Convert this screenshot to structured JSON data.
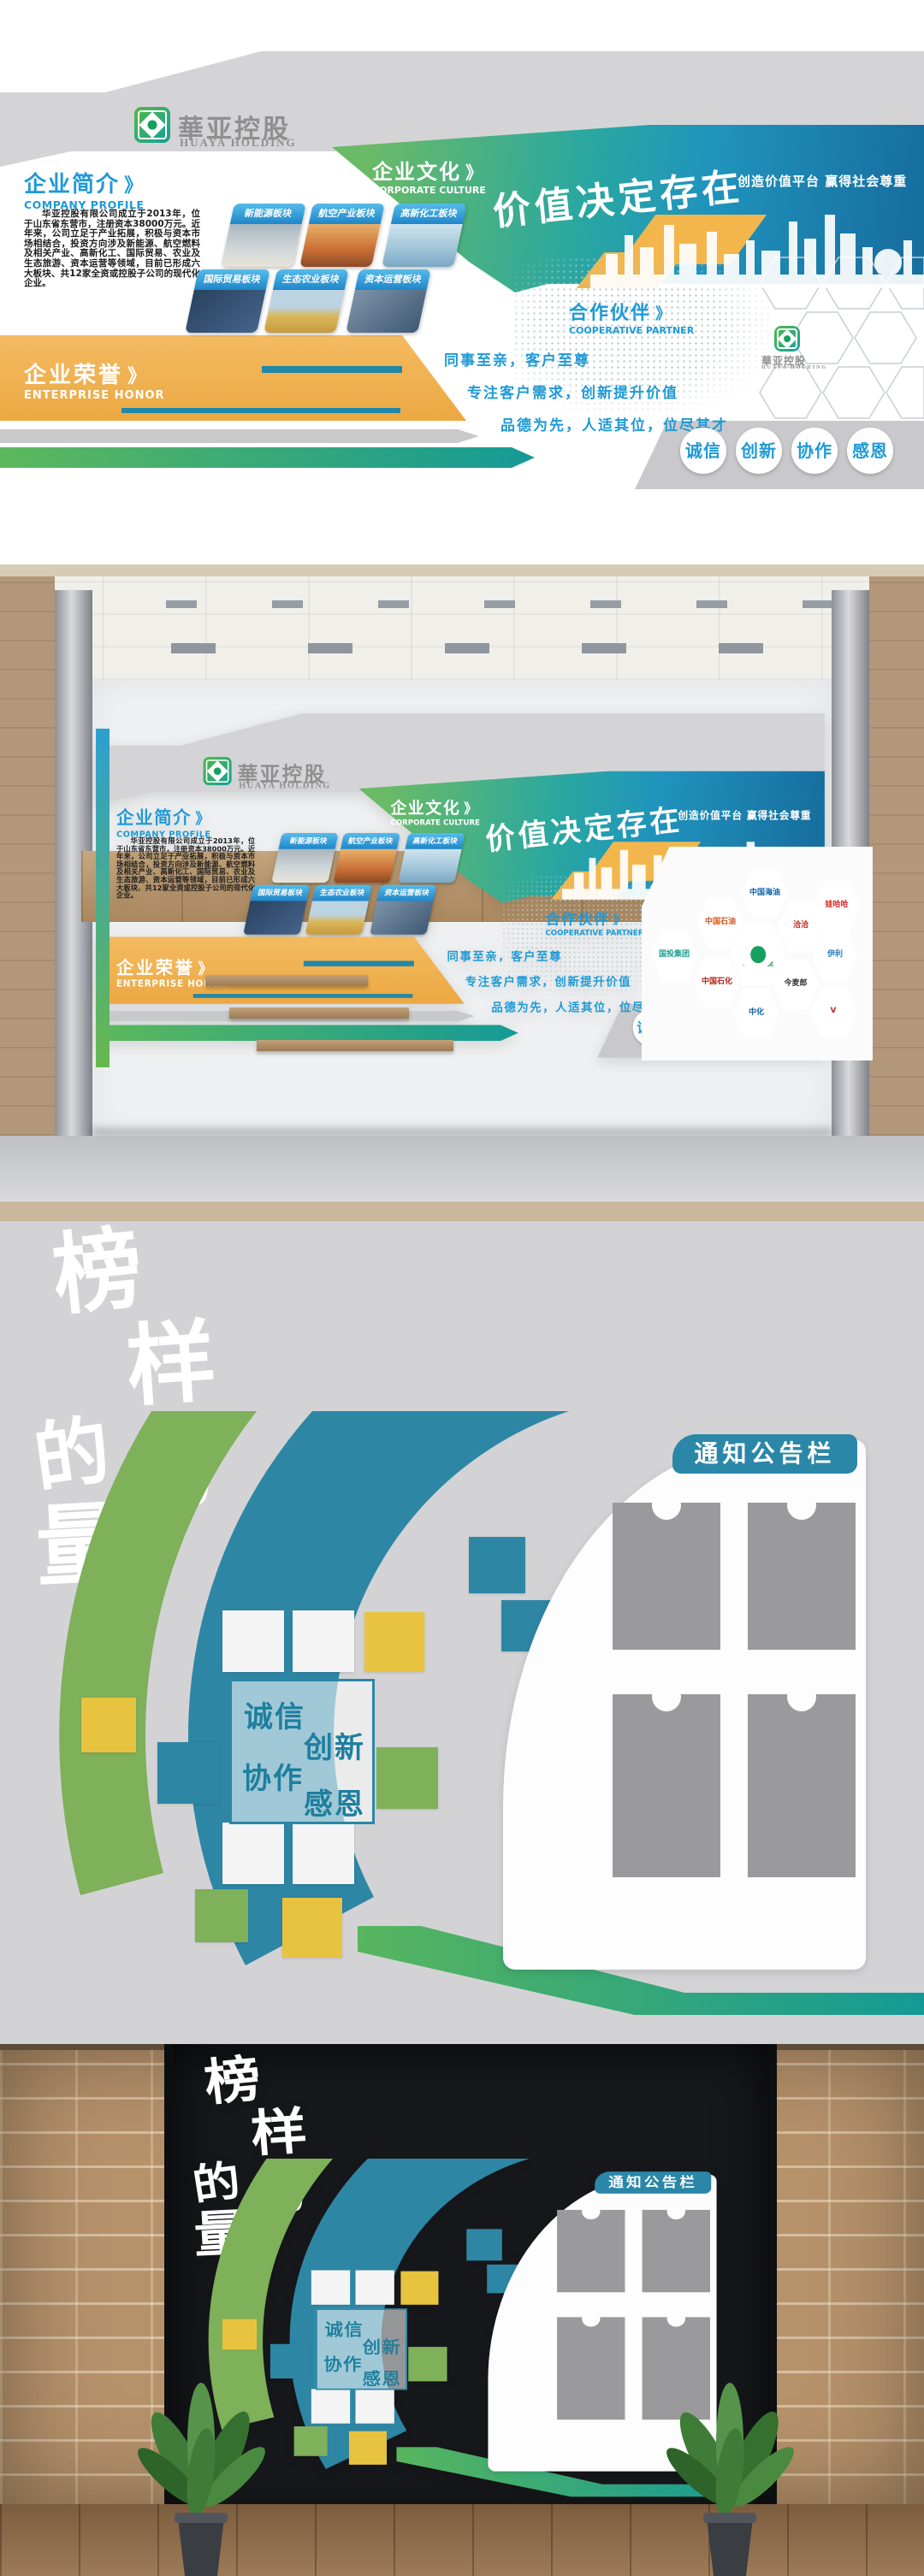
{
  "brand": {
    "logo_cn": "華亚控股",
    "logo_en": "HUAYA HOLDING"
  },
  "decor": {
    "chevron": "》"
  },
  "design1": {
    "profile": {
      "title_cn": "企业简介",
      "title_en": "COMPANY PROFILE",
      "body": "华亚控股有限公司成立于2013年，位于山东省东营市，注册资本38000万元。近年来，公司立足于产业拓展，积极与资本市场相结合，投资方向涉及新能源、航空燃料及相关产业、高新化工、国际贸易、农业及生态旅游、资本运营等领域，目前已形成六大板块、共12家全资或控股子公司的现代化企业。"
    },
    "sectors": [
      "新能源板块",
      "航空产业板块",
      "高新化工板块",
      "国际贸易板块",
      "生态农业板块",
      "资本运营板块"
    ],
    "culture": {
      "title_cn": "企业文化",
      "title_en": "CORPORATE CULTURE",
      "slogan": "价值决定存在",
      "subslogan": "创造价值平台 赢得社会尊重"
    },
    "partner": {
      "title_cn": "合作伙伴",
      "title_en": "COOPERATIVE PARTNER"
    },
    "honor": {
      "title_cn": "企业荣誉",
      "title_en": "ENTERPRISE HONOR"
    },
    "mottoes": [
      "同事至亲，客户至尊",
      "专注客户需求，创新提升价值",
      "品德为先，人适其位，位尽其才"
    ],
    "values": [
      "诚信",
      "创新",
      "协作",
      "感恩"
    ]
  },
  "render1": {
    "partners": [
      {
        "label": "中国海油",
        "color": "#1160a6"
      },
      {
        "label": "娃哈哈",
        "color": "#d02a2a"
      },
      {
        "label": "中国石油",
        "color": "#d4571e"
      },
      {
        "label": "洽洽",
        "color": "#cc2222"
      },
      {
        "label": "国投集团",
        "color": "#1a9e8f"
      },
      {
        "label": "華亚控股",
        "color": "#2f9e52"
      },
      {
        "label": "伊利",
        "color": "#2a7fc0"
      },
      {
        "label": "中国石化",
        "color": "#b02318"
      },
      {
        "label": "今麦郎",
        "color": "#333333"
      },
      {
        "label": "V",
        "color": "#cc2222"
      },
      {
        "label": "中化",
        "color": "#1565a8"
      }
    ]
  },
  "design2": {
    "title": "榜样的力量",
    "title_chars": [
      "榜",
      "样",
      "的",
      "力",
      "量"
    ],
    "board_title": "通知公告栏",
    "values": [
      "诚信",
      "创新",
      "协作",
      "感恩"
    ]
  },
  "palette": {
    "heading_blue": "#1e9ad6",
    "teal": "#1a9c9b",
    "green": "#5cb85c",
    "banner_blue": "#176fa0",
    "orange_band": "#efb257",
    "yellow": "#e8c33f",
    "board_teal": "#2b87a8",
    "gray_band": "#c9c9cb",
    "wood": "#b3977a",
    "brick": "#b6926b",
    "dark_wall": "#17181b"
  }
}
